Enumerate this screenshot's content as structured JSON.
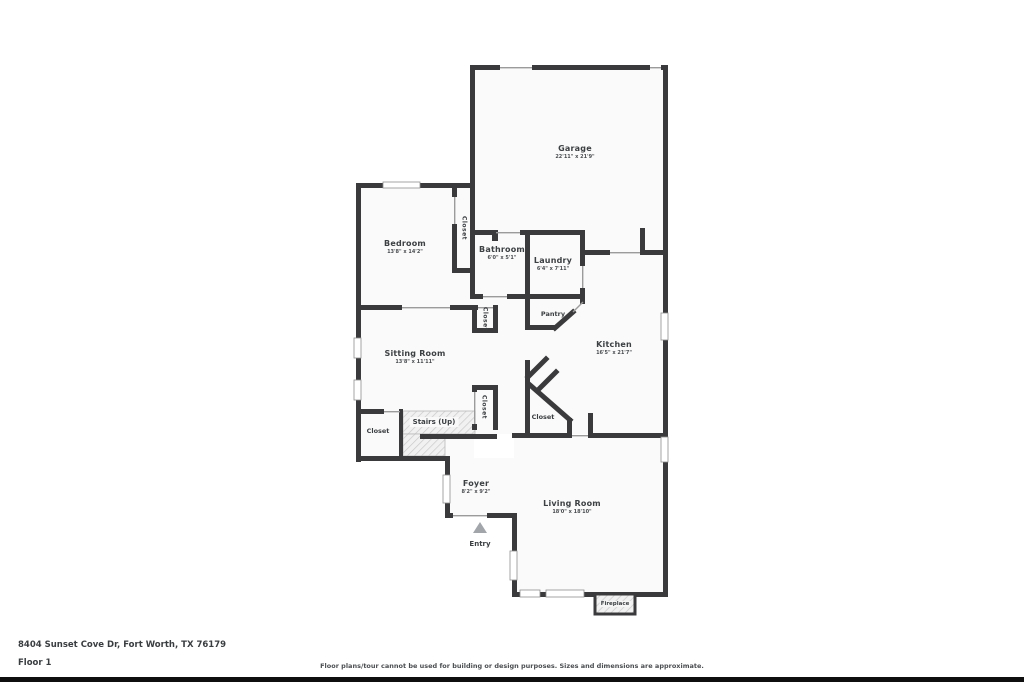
{
  "rooms": {
    "garage": {
      "name": "Garage",
      "dims": "22'11\" x 21'9\""
    },
    "bedroom": {
      "name": "Bedroom",
      "dims": "13'8\" x 14'2\""
    },
    "bathroom": {
      "name": "Bathroom",
      "dims": "6'0\" x 5'1\""
    },
    "laundry": {
      "name": "Laundry",
      "dims": "6'4\" x 7'11\""
    },
    "pantry": {
      "name": "Pantry",
      "dims": ""
    },
    "kitchen": {
      "name": "Kitchen",
      "dims": "16'5\" x 21'7\""
    },
    "sitting_room": {
      "name": "Sitting Room",
      "dims": "13'8\" x 11'11\""
    },
    "foyer": {
      "name": "Foyer",
      "dims": "8'2\" x 9'2\""
    },
    "living_room": {
      "name": "Living Room",
      "dims": "18'0\" x 18'10\""
    }
  },
  "labels": {
    "closet": "Closet",
    "pantry": "Pantry",
    "stairs": "Stairs (Up)",
    "entry": "Entry",
    "fireplace": "Fireplace"
  },
  "footer": {
    "address": "8404 Sunset Cove Dr, Fort Worth, TX 76179",
    "floor": "Floor 1",
    "disclaimer": "Floor plans/tour cannot be used for building or design purposes. Sizes and dimensions are approximate."
  },
  "colors": {
    "wall": "#3a3a3c",
    "opening": "#9b9b9b",
    "room_fill": "#fafafa",
    "entry_arrow": "#a2a6ab",
    "bottom_bar": "#0f0f0f"
  }
}
